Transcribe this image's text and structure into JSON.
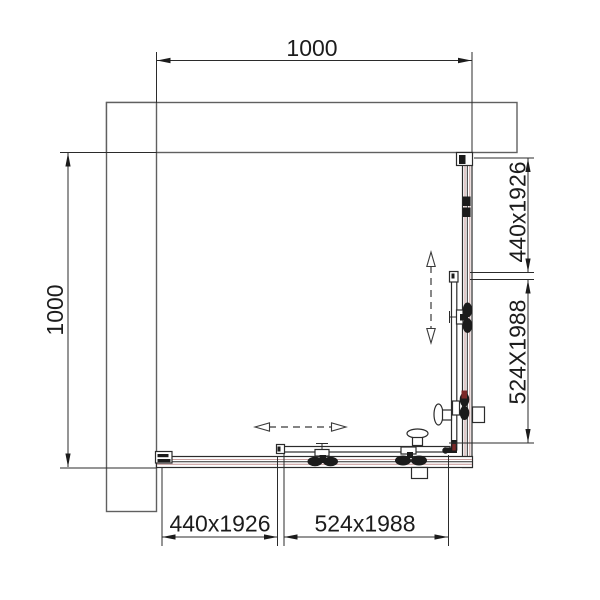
{
  "dimensions": {
    "top_width": "1000",
    "left_height": "1000",
    "right_side": {
      "fixed_panel": "440x1926",
      "sliding_door": "524X1988"
    },
    "bottom_side": {
      "fixed_panel": "440x1926",
      "sliding_door": "524x1988"
    }
  },
  "colors": {
    "line": "#2b2b2b",
    "wall_line": "#606060",
    "glass_accent": "#c9a0a0",
    "corner_accent": "#7a2828",
    "hardware_dark": "#1b1b1b"
  }
}
